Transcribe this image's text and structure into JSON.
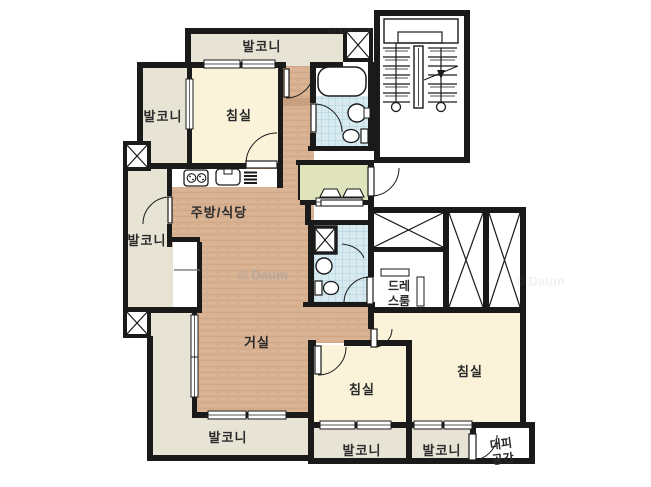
{
  "meta": {
    "type_label": "apartment floor plan",
    "watermark": "© Daum"
  },
  "colors": {
    "wall": "#1a1a1a",
    "balcony": "#e8e4d5",
    "bedroom": "#faf3da",
    "wood": "#d7b191",
    "tile": "#d7eaf0",
    "entrance": "#e0e4bd",
    "watermark_gray": "#9aa0a6"
  },
  "rooms": {
    "balcony_top": {
      "label": "발코니"
    },
    "balcony_upper_left": {
      "label": "발코니"
    },
    "bedroom_top": {
      "label": "침실"
    },
    "balcony_left": {
      "label": "발코니"
    },
    "kitchen_dining": {
      "label": "주방/식당"
    },
    "living_room": {
      "label": "거실"
    },
    "balcony_bottom_left": {
      "label": "발코니"
    },
    "dress_room": {
      "label": "드레스룸",
      "line1": "드레",
      "line2": "스룸"
    },
    "bedroom_center": {
      "label": "침실"
    },
    "bedroom_right": {
      "label": "침실"
    },
    "balcony_bottom_center": {
      "label": "발코니"
    },
    "balcony_bottom_right": {
      "label": "발코니"
    },
    "shelter": {
      "label": "대피공간",
      "line1": "대피",
      "line2": "공간"
    }
  }
}
